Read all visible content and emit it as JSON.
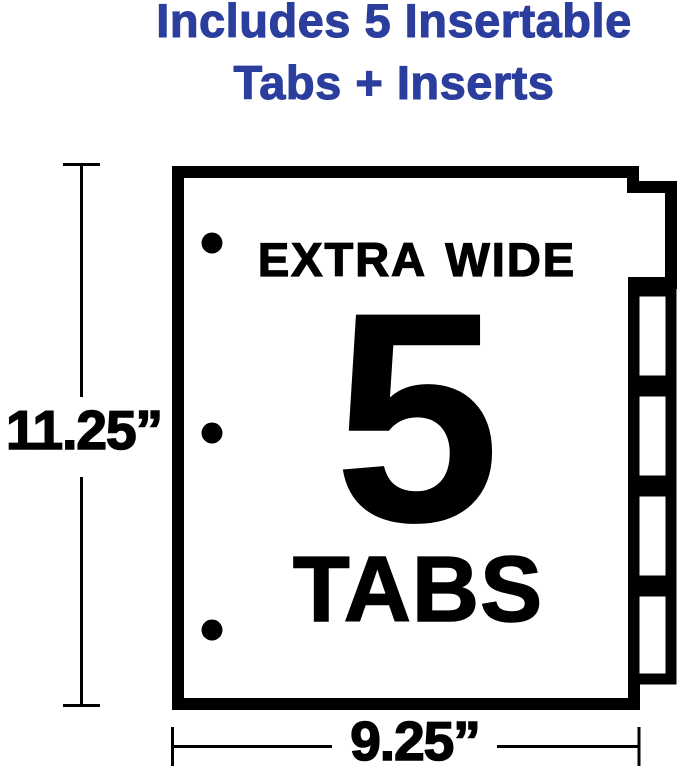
{
  "heading": {
    "line1": "Includes 5 Insertable",
    "line2": "Tabs + Inserts"
  },
  "divider_sheet": {
    "label_top": "EXTRA WIDE",
    "tab_count": "5",
    "label_bottom": "TABS",
    "tabs_shown": 5,
    "binder_holes_shown": 3
  },
  "dimensions": {
    "height": "11.25”",
    "width": "9.25”"
  },
  "colors": {
    "accent_blue": "#2b3e9d",
    "ink": "#000000",
    "background": "#ffffff"
  }
}
